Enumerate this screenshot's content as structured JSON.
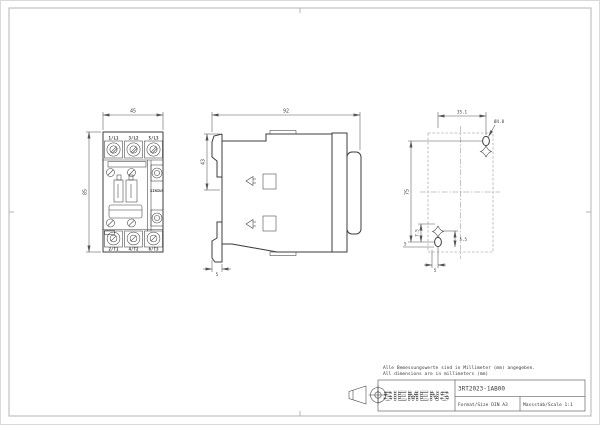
{
  "sheet": {
    "note_line1": "Alle Bemessungswerte sind in Millimeter (mm) angegeben.",
    "note_line2": "All dimensions are in millimeters (mm)",
    "manufacturer_logo": "SIEMENS",
    "part_number": "3RT2023-1AB00",
    "format": "Format/Size DIN A3",
    "scale": "Massstab/Scale 1:1"
  },
  "front_view": {
    "product_brand": "SIRIUS",
    "dim_width": "45",
    "dim_height": "85",
    "terminals_top": [
      "1/L1",
      "3/L2",
      "5/L3"
    ],
    "terminals_bottom": [
      "2/T1",
      "4/T2",
      "6/T3"
    ]
  },
  "side_view": {
    "dim_depth": "92",
    "dim_upper": "43",
    "dim_rail": "5"
  },
  "drill_view": {
    "dim_hole_spacing_x": "35.1",
    "dim_hole_spacing_y": "75",
    "hole_diameter": "Ø4.8",
    "dim_offset_a": "7.5",
    "dim_offset_b": "5",
    "dim_offset_c": "5.5",
    "dim_offset_d": "5"
  },
  "colors": {
    "object_line": "#3c3c3c",
    "dimension_line": "#555555",
    "frame": "#b4b4b4",
    "background": "#ffffff"
  }
}
